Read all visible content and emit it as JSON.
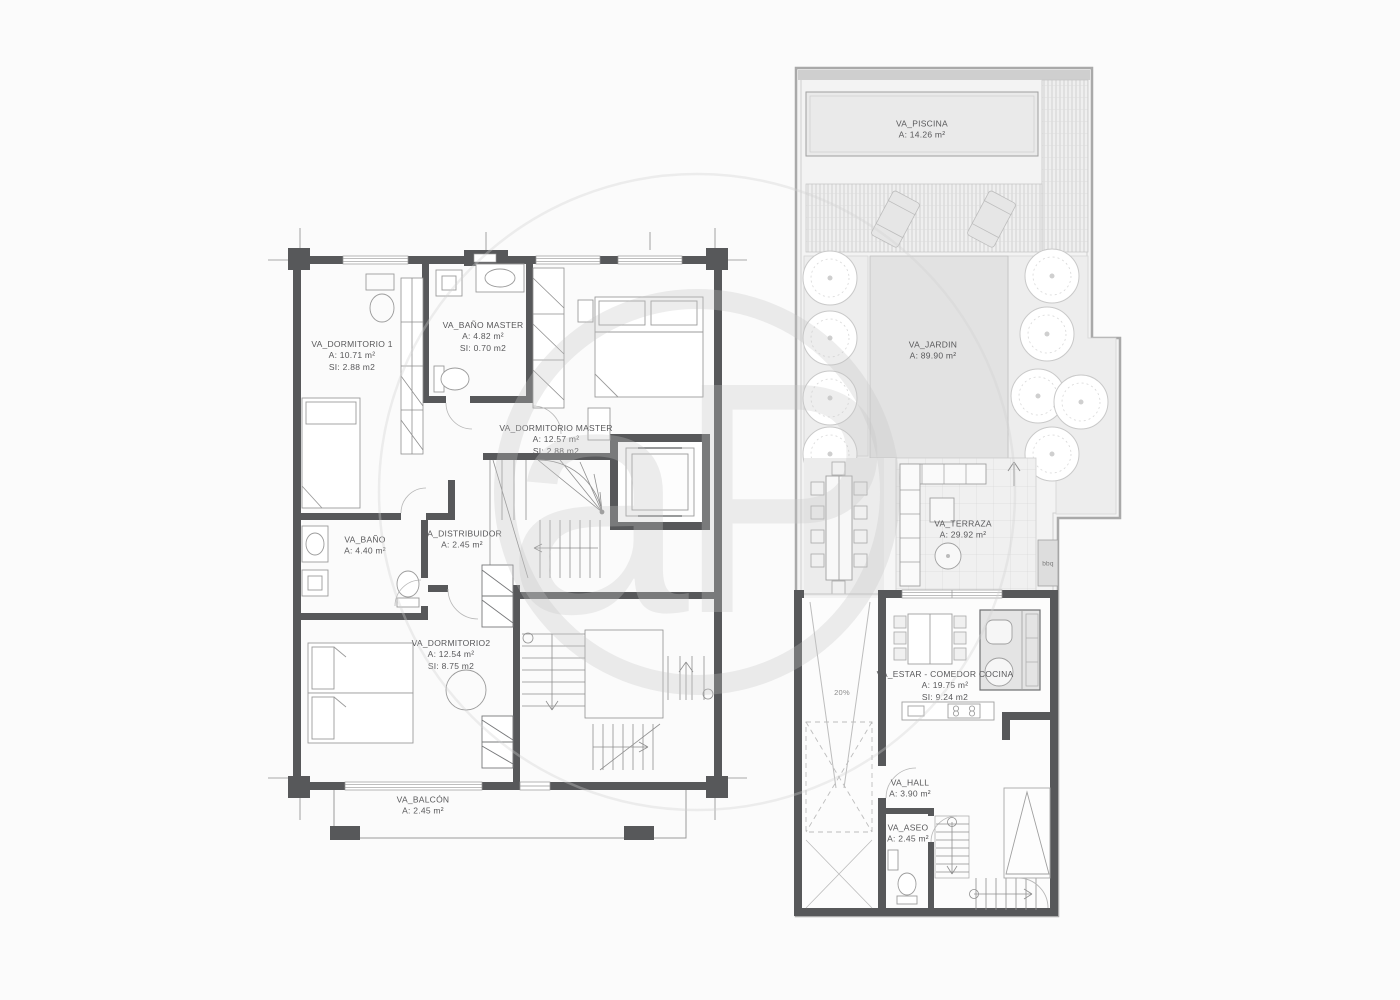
{
  "watermark": {
    "text": "aP"
  },
  "colors": {
    "wall": "#57585a",
    "furniture_line": "#9b9b9b",
    "site_ground": "#f3f3f3",
    "pool_fill": "#eaeaea",
    "garden_fill": "#e2e2e2",
    "label_text": "#58585a",
    "watermark_gray": "#c8c8c8"
  },
  "left_plan": {
    "rooms": [
      {
        "name": "VA_DORMITORIO 1",
        "area": "A: 10.71 m²",
        "si": "SI: 2.88 m2"
      },
      {
        "name": "VA_BAÑO MASTER",
        "area": "A: 4.82 m²",
        "si": "SI: 0.70 m2"
      },
      {
        "name": "VA_DORMITORIO MASTER",
        "area": "A: 12.57 m²",
        "si": "SI: 2.88 m2"
      },
      {
        "name": "VA_DISTRIBUIDOR",
        "area": "A: 2.45 m²"
      },
      {
        "name": "VA_BAÑO",
        "area": "A: 4.40 m²"
      },
      {
        "name": "VA_DORMITORIO2",
        "area": "A: 12.54 m²",
        "si": "SI: 8.75 m2"
      },
      {
        "name": "VA_BALCÓN",
        "area": "A: 2.45 m²"
      }
    ]
  },
  "right_plan": {
    "rooms": [
      {
        "name": "VA_PISCINA",
        "area": "A: 14.26 m²"
      },
      {
        "name": "VA_JARDIN",
        "area": "A: 89.90 m²"
      },
      {
        "name": "VA_TERRAZA",
        "area": "A: 29.92 m²"
      },
      {
        "name": "VA_ESTAR - COMEDOR COCINA",
        "area": "A: 19.75 m²",
        "si": "SI: 9.24 m2"
      },
      {
        "name": "VA_HALL",
        "area": "A: 3.90 m²"
      },
      {
        "name": "VA_ASEO",
        "area": "A: 2.45 m²"
      }
    ],
    "annotations": [
      {
        "label": "bbq"
      },
      {
        "label": "20%"
      }
    ]
  }
}
